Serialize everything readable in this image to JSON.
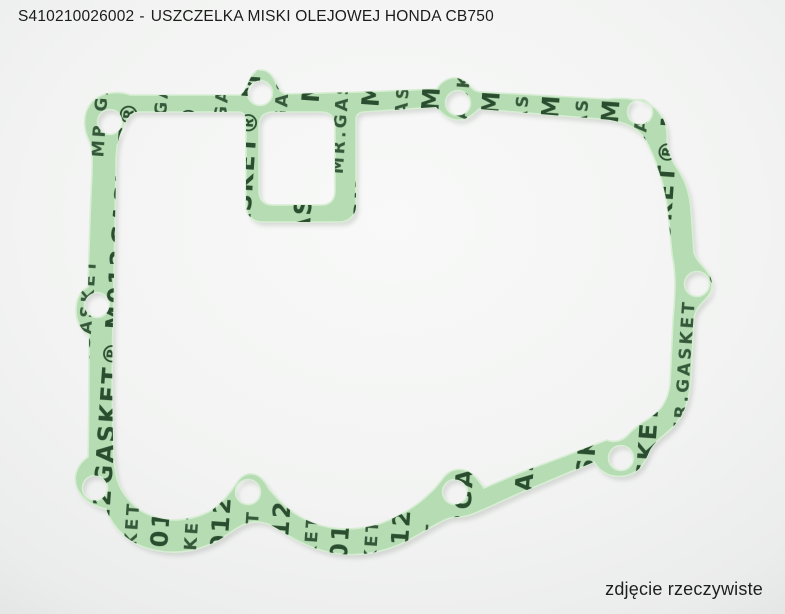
{
  "header": {
    "part_number": "S410210026002",
    "separator": "-",
    "product_name": "USZCZELKA MISKI OLEJOWEJ HONDA CB750"
  },
  "photo": {
    "caption": "zdjęcie rzeczywiste",
    "subject": "oil-pan-paper-gasket",
    "bolt_hole_count": 10,
    "watermark": {
      "line1": "GASKET® M0128",
      "line2": "MR.GASKET"
    },
    "colors": {
      "gasket_material": "#b6dcb3",
      "gasket_edge": "#d8eed4",
      "gasket_print": "#1e4124",
      "background": "#f0f1f0",
      "text": "#1c1c1c"
    }
  }
}
